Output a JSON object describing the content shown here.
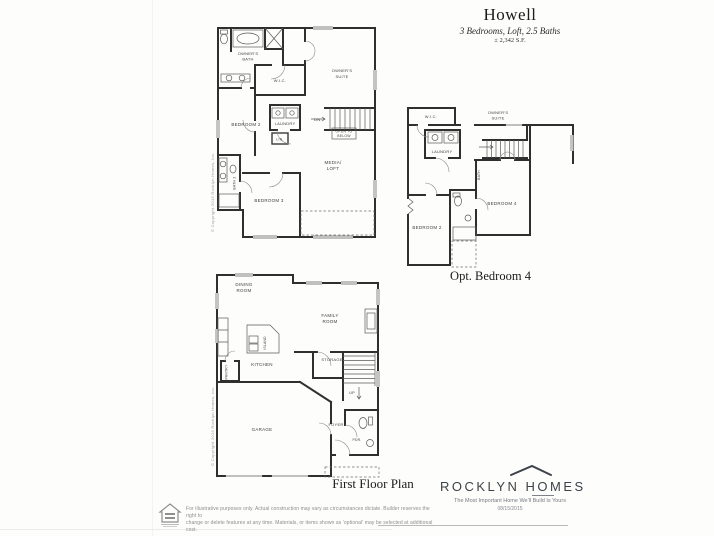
{
  "title": {
    "name": "Howell",
    "subtitle": "3 Bedrooms, Loft, 2.5 Baths",
    "sqft": "± 2,342 S.F."
  },
  "plans": {
    "second_floor": {
      "rooms": {
        "owners_bath": [
          "OWNER'S",
          "BATH"
        ],
        "wic": "W.I.C.",
        "owners_suite": [
          "OWNER'S",
          "SUITE"
        ],
        "bedroom2": "BEDROOM 2",
        "laundry": "LAUNDRY",
        "dn": "DN.",
        "open_below": [
          "OPEN TO",
          "BELOW"
        ],
        "media_loft": [
          "MEDIA/",
          "LOFT"
        ],
        "bedroom3": "BEDROOM 3",
        "bath2": "BATH 2",
        "lin": "LIN."
      }
    },
    "opt_bedroom4": {
      "caption": "Opt. Bedroom 4",
      "rooms": {
        "wic": "W.I.C.",
        "owners_suite": [
          "OWNER'S",
          "SUITE"
        ],
        "laundry": "LAUNDRY",
        "bath": "BATH",
        "bedroom4": "BEDROOM 4",
        "bedroom2": "BEDROOM 2"
      }
    },
    "first_floor": {
      "caption": "First Floor Plan",
      "rooms": {
        "dining": [
          "DINING",
          "ROOM"
        ],
        "family": [
          "FAMILY",
          "ROOM"
        ],
        "kitchen": "KITCHEN",
        "island": "ISLAND",
        "pantry": "PANTRY",
        "storage": "STORAGE",
        "up": "UP",
        "garage": "GARAGE",
        "foyer": "FOYER",
        "pdr": "PDR."
      }
    }
  },
  "footer": {
    "disclaimer_line1": "For illustrative purposes only. Actual construction may vary as circumstances dictate. Builder reserves the right to",
    "disclaimer_line2": "change or delete features at any time. Materials, or items shown as 'optional' may be selected at additional cost.",
    "brand": "ROCKLYN HOMES",
    "tagline": "The Most Important Home We'll Build Is Yours",
    "date": "08/15/2015"
  },
  "copyright_vertical": "© Copyright 2015 Rocklyn Homes, Inc.",
  "colors": {
    "wall_line": "#2f2f2f",
    "label_text": "#414141",
    "brand_text": "#3d4248",
    "muted_text": "#8c8c8c"
  }
}
